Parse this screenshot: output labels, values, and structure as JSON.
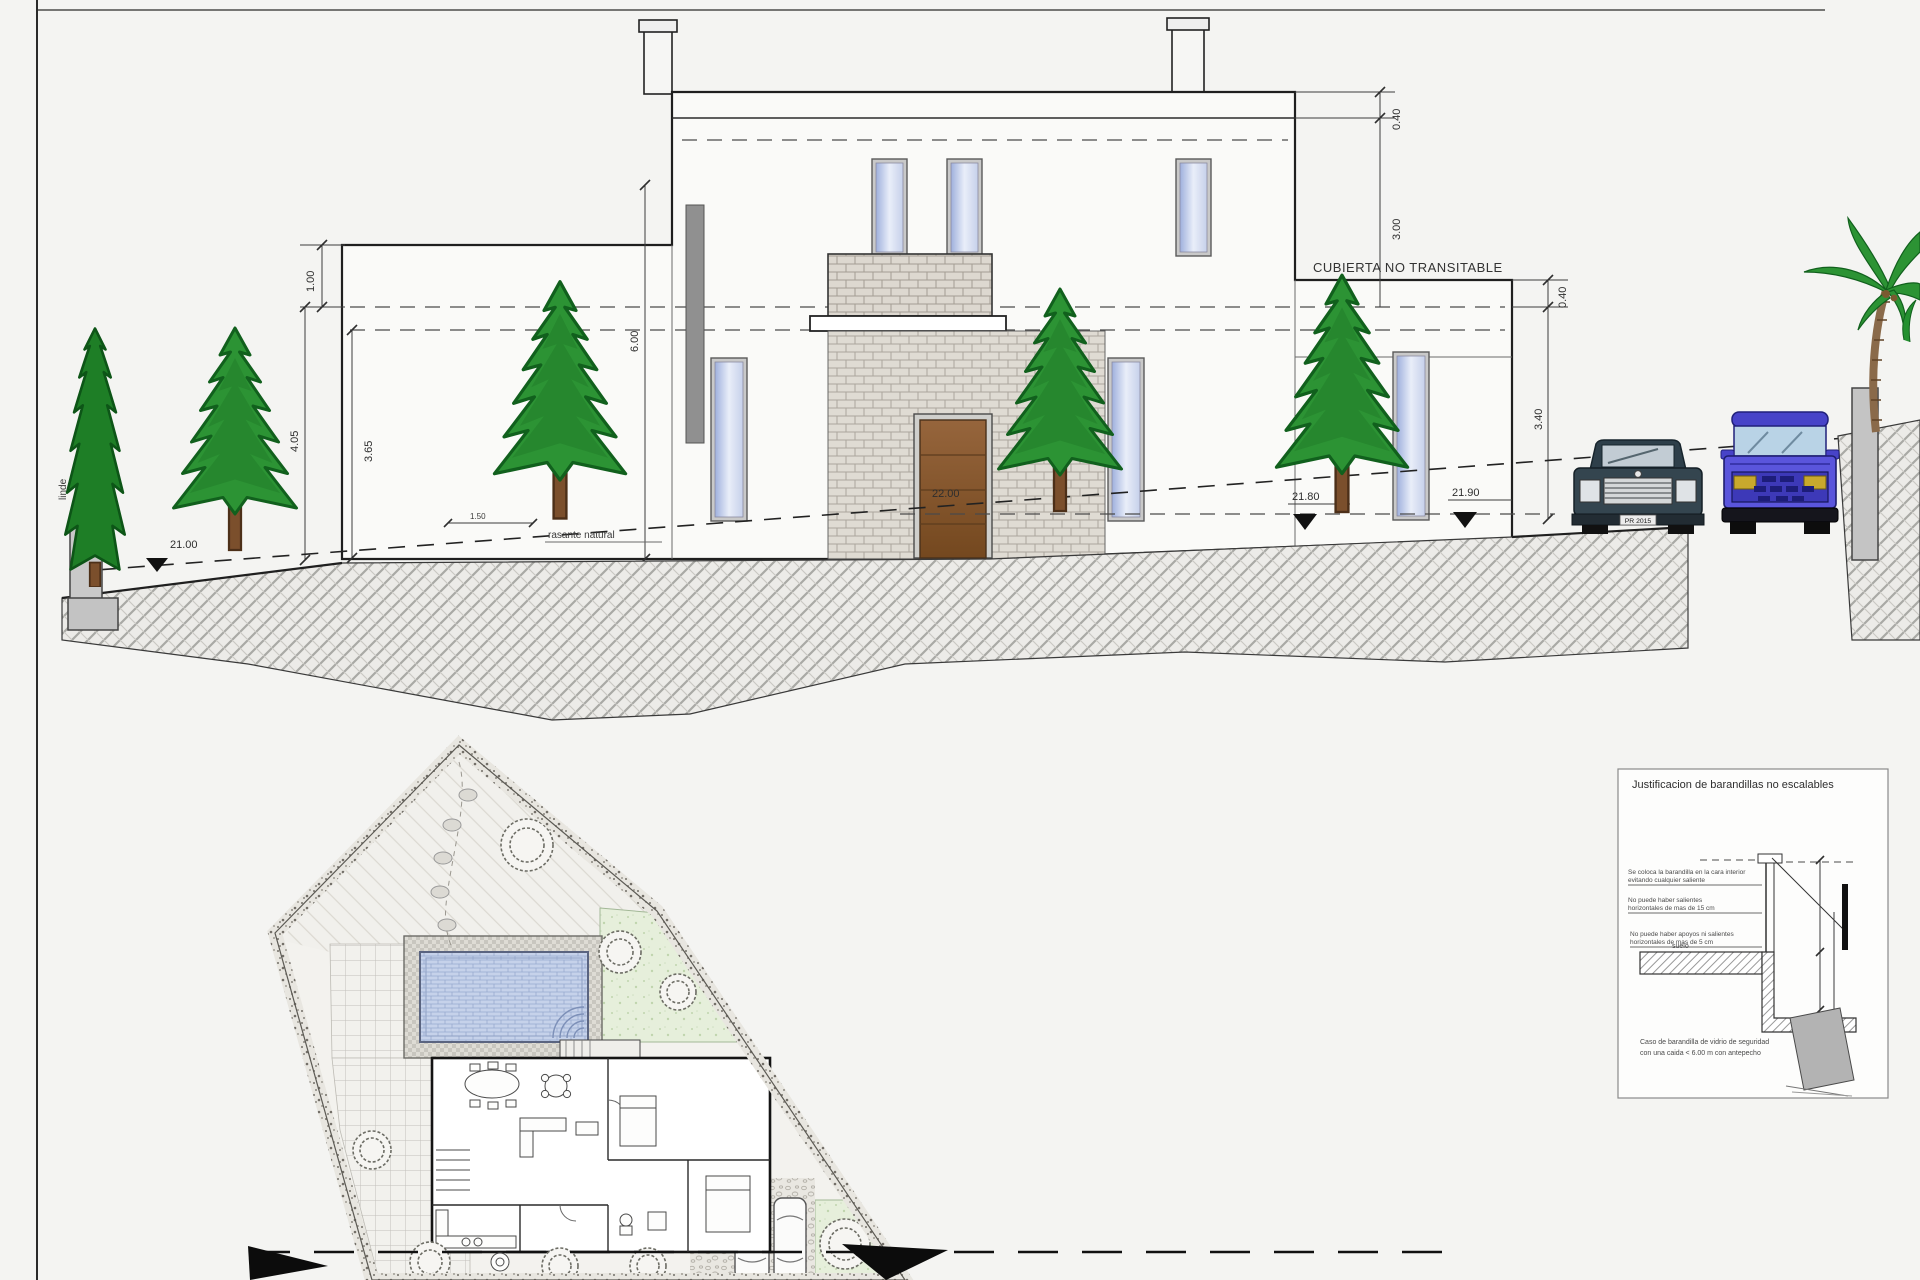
{
  "drawing": {
    "roof_label": "CUBIERTA NO TRANSITABLE",
    "dims": {
      "upper_roof_edge": "0.40",
      "upper_floor_height": "3.00",
      "lower_roof_edge": "0.40",
      "lower_floor_height": "3.40",
      "left_parapet": "1.00",
      "left_wall": "4.05",
      "left_interior": "3.65",
      "facade_height": "6.00",
      "grade_offset": "1.50"
    },
    "levels": {
      "entrance_door": "22.00",
      "street_left": "21.80",
      "street_right": "21.90",
      "plot_corner": "21.00"
    },
    "labels": {
      "boundary": "linde",
      "natural_grade": "rasante natural"
    },
    "car_plate": "PR 2015"
  },
  "detail_box": {
    "title": "Justificacion de barandillas no escalables",
    "note1a": "Se coloca la barandilla en la cara interior",
    "note1b": "evitando cualquier saliente",
    "note2a": "No puede haber salientes",
    "note2b": "horizontales de mas de 15 cm",
    "note3a": "No puede haber apoyos ni salientes",
    "note3b": "horizontales de mas de 5 cm",
    "floor_label": "suelo",
    "caption1": "Caso de barandilla de vidrio de seguridad",
    "caption2": "con una caida < 6.00 m con antepecho"
  },
  "colors": {
    "background": "#f4f4f2",
    "line": "#2b2b2b",
    "tree_green": "#2c9334",
    "pool_blue": "#c6d2ea",
    "lawn_green": "#e6efdb",
    "door_brown": "#8a5a33",
    "sedan_dark": "#36474f",
    "suv_blue": "#5a55dc",
    "glass_blue": "#aab6e4"
  }
}
